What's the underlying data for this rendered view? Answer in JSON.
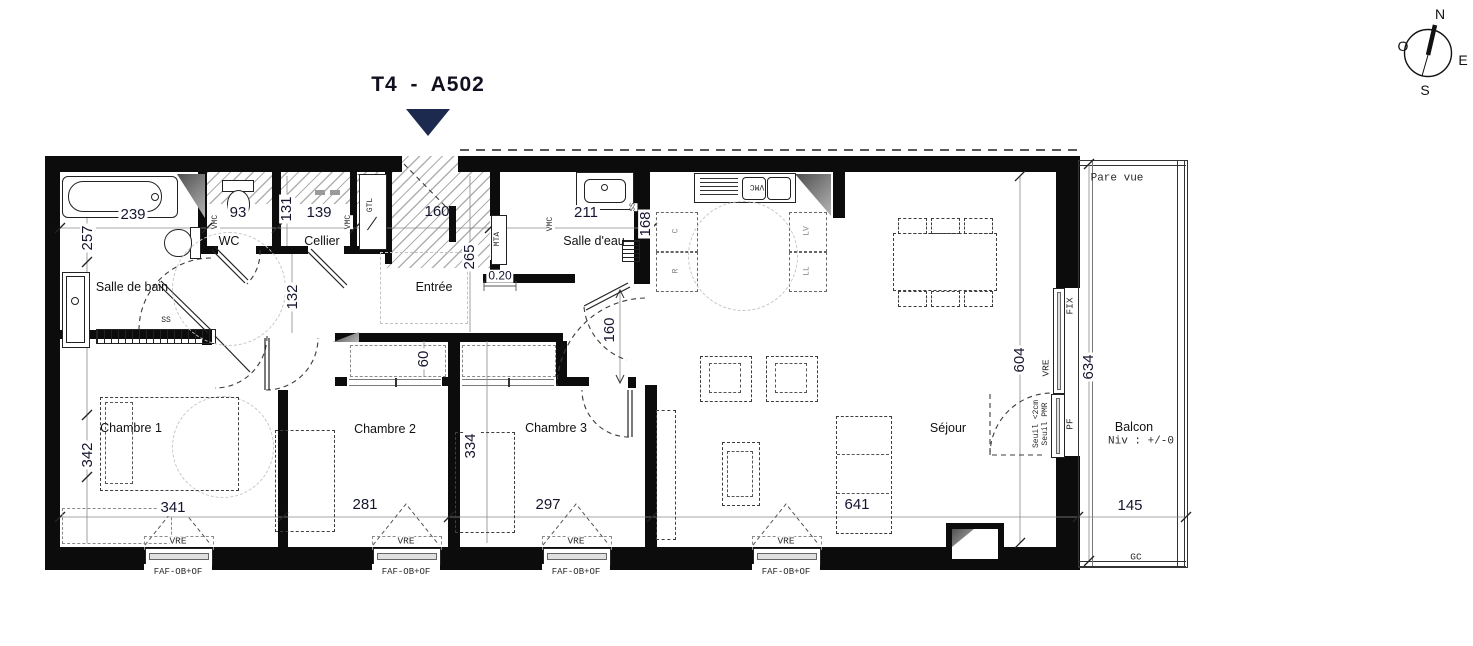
{
  "title": "T4 - A502",
  "compass": {
    "n": "N",
    "e": "E",
    "s": "S",
    "o": "O"
  },
  "rooms": {
    "salle_de_bain": "Salle de bain",
    "wc": "WC",
    "cellier": "Cellier",
    "entree": "Entrée",
    "salle_deau": "Salle d'eau",
    "chambre1": "Chambre 1",
    "chambre2": "Chambre 2",
    "chambre3": "Chambre 3",
    "sejour": "Séjour",
    "balcon": "Balcon"
  },
  "balcony": {
    "level": "Niv : +/-0",
    "pare_vue": "Pare vue",
    "gc": "GC"
  },
  "dims": {
    "bath_w": "239",
    "bath_side": "257",
    "wc_w": "93",
    "d131": "131",
    "cellier_w": "139",
    "entree_w": "160",
    "entree_d": "265",
    "wall_020": "0.20",
    "sde_w": "211",
    "sde_d": "168",
    "hall_d": "132",
    "niche_d": "60",
    "kitchen_open": "160",
    "ch1_d": "342",
    "ch1_w": "341",
    "ch2_w": "281",
    "ch23_d": "334",
    "ch3_w": "297",
    "sejour_w": "641",
    "sejour_d": "604",
    "balcon_d": "634",
    "balcon_w": "145"
  },
  "annotations": {
    "vre": "VRE",
    "faf": "FAF-OB+OF",
    "fix": "FIX",
    "pf": "PF",
    "seuil_2cm": "Seuil <2cm",
    "seuil_pmr": "Seuil PMR",
    "vmc": "VMC",
    "gtl": "GTL",
    "mta": "MTA",
    "ss": "SS",
    "lv": "LV",
    "ll": "LL",
    "r": "R",
    "c": "C"
  }
}
